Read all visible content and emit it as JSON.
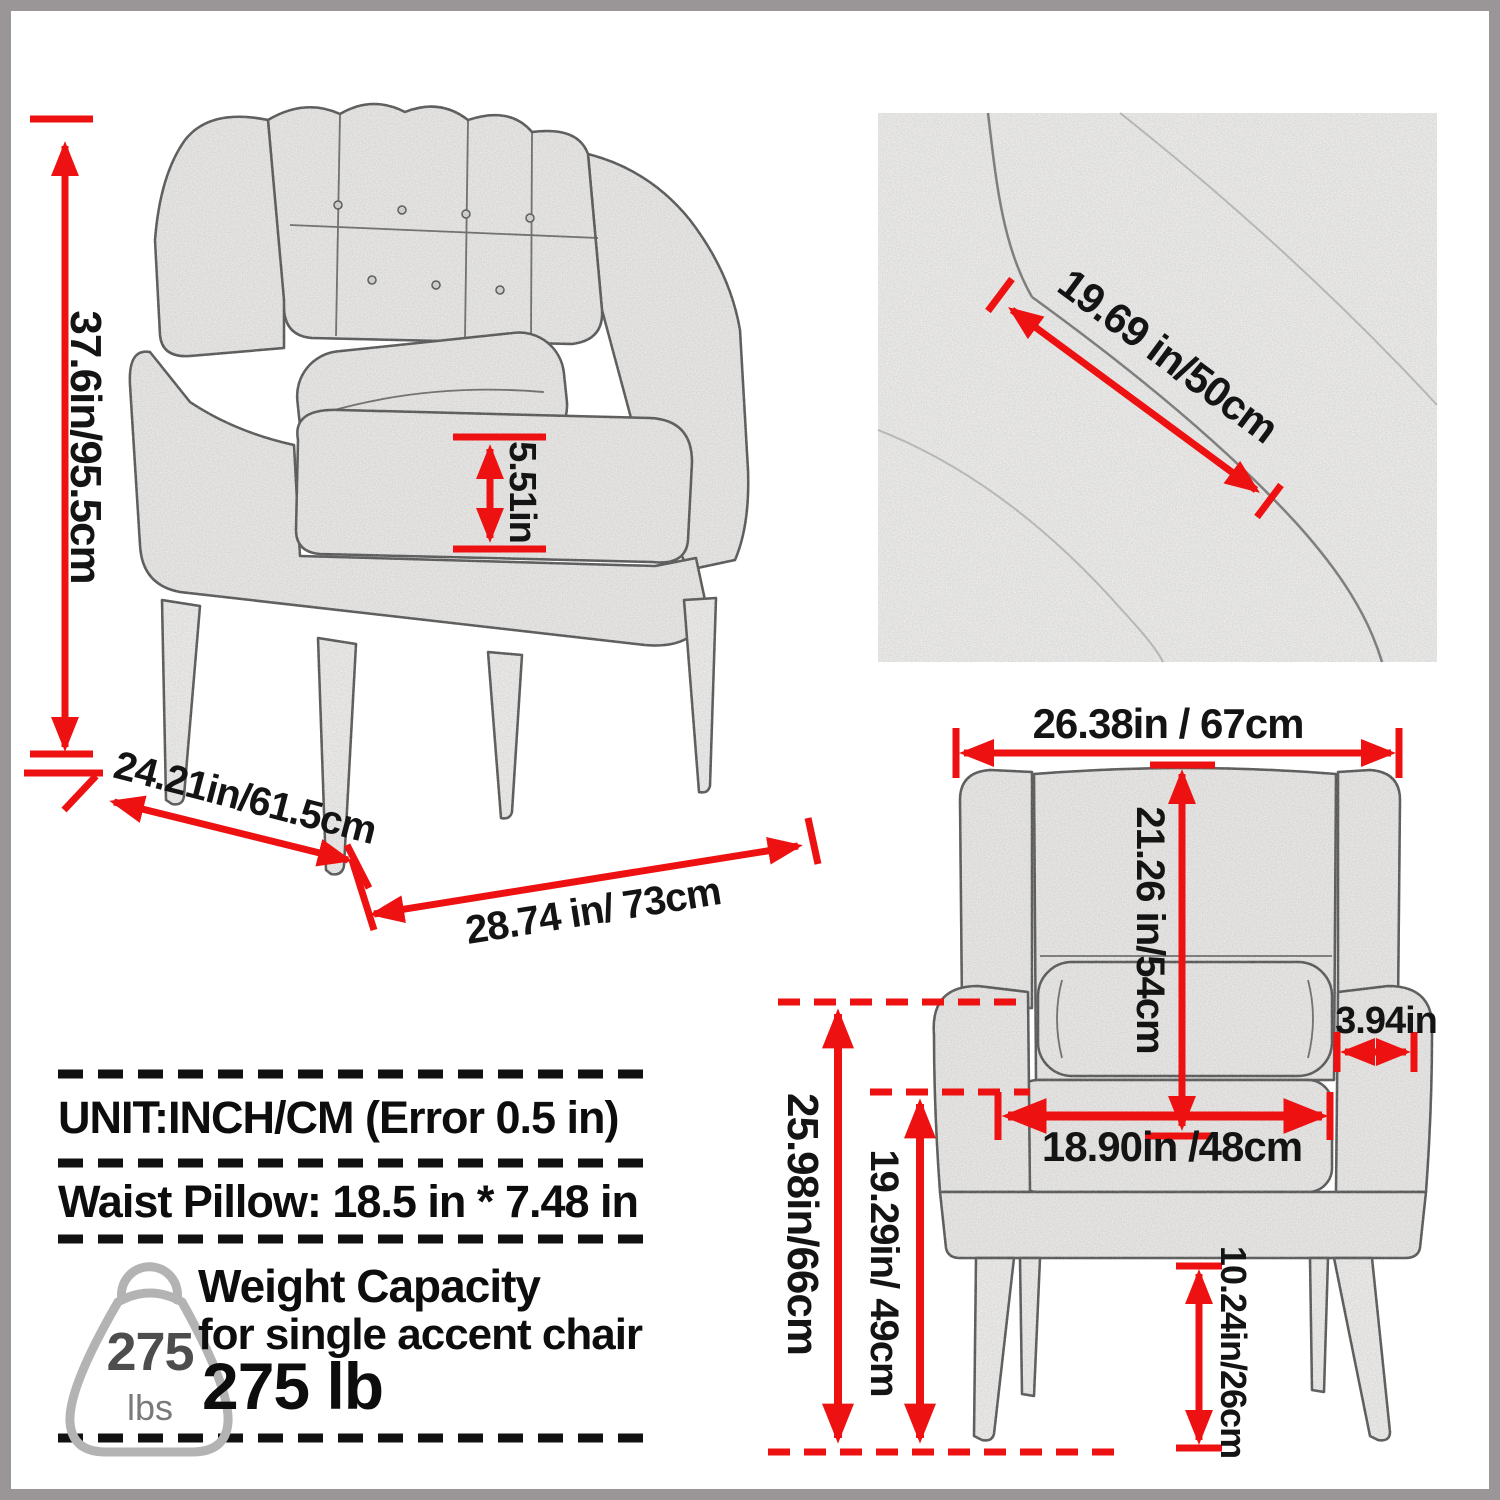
{
  "palette": {
    "red": "#ee1111",
    "text": "#141414",
    "border_gray": "#9a9596",
    "sketch_fill": "#f2f1ef",
    "sketch_stroke": "#3f3f3f"
  },
  "side_view": {
    "height": "37.6in/95.5cm",
    "arm_cushion_height": "5.51in",
    "depth": "24.21in/61.5cm",
    "width": "28.74 in/ 73cm"
  },
  "closeup_view": {
    "back_diagonal": "19.69 in/50cm"
  },
  "front_view": {
    "overall_width": "26.38in / 67cm",
    "back_height": "21.26 in/54cm",
    "armrest_width": "3.94in",
    "seat_width": "18.90in /48cm",
    "arm_top_height": "25.98in/66cm",
    "seat_front_height": "19.29in/ 49cm",
    "leg_height": "10.24in/26cm"
  },
  "notes": {
    "unit": "UNIT:INCH/CM (Error 0.5 in)",
    "waist_pillow": "Waist Pillow: 18.5 in * 7.48 in"
  },
  "weight": {
    "title": "Weight Capacity",
    "subtitle": "for single accent chair",
    "value": "275 lb",
    "badge_value": "275",
    "badge_unit": "lbs"
  }
}
